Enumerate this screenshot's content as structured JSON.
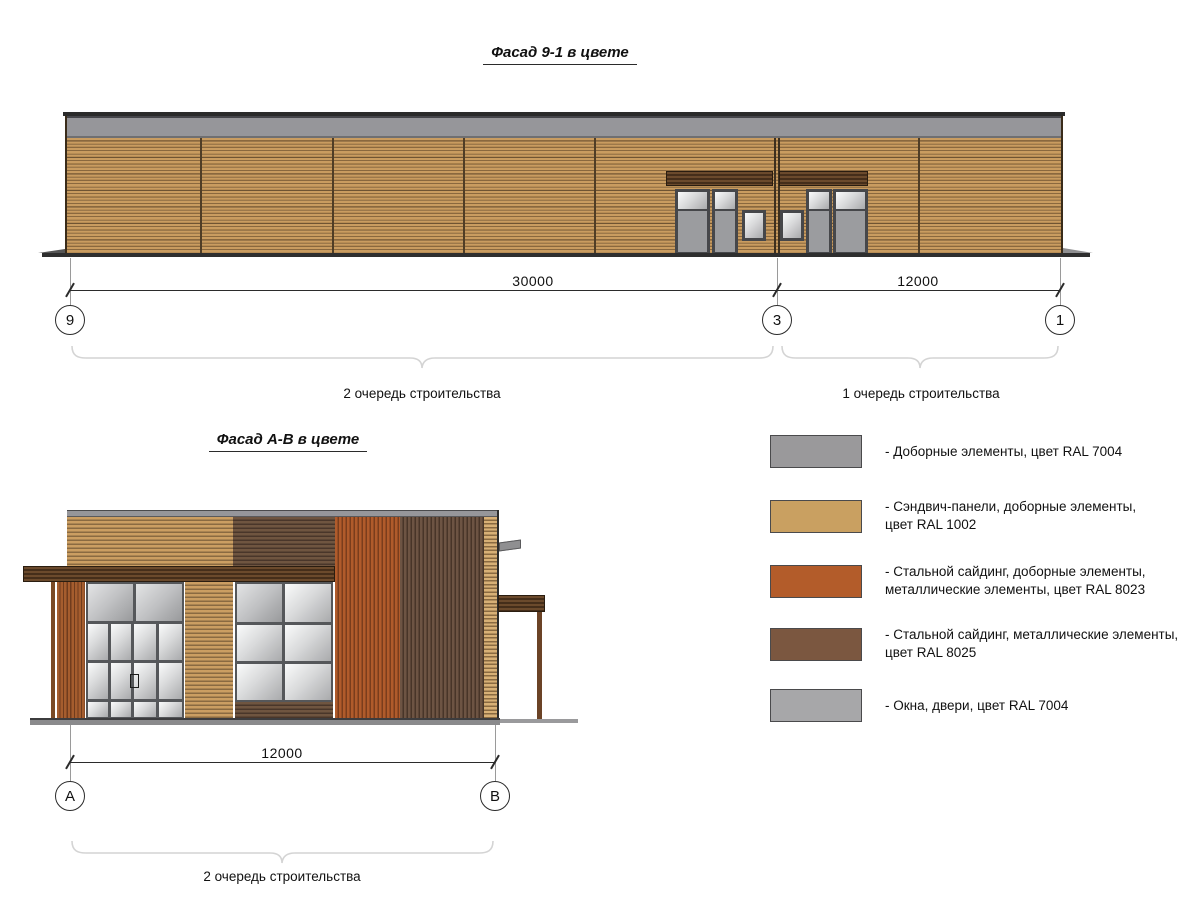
{
  "facade_9_1": {
    "title": "Фасад 9-1 в цвете",
    "dim_9_3": "30000",
    "dim_3_1": "12000",
    "grid_9": "9",
    "grid_3": "3",
    "grid_1": "1",
    "phase_left": "2 очередь строительства",
    "phase_right": "1 очередь строительства"
  },
  "facade_a_b": {
    "title": "Фасад А-В в цвете",
    "dim_a_b": "12000",
    "grid_a": "А",
    "grid_b": "В",
    "phase": "2 очередь строительства"
  },
  "legend": {
    "items": [
      {
        "color": "#9a999b",
        "ral": "RAL 7004",
        "lines": [
          "- Доборные элементы, цвет RAL 7004"
        ]
      },
      {
        "color": "#c9a061",
        "ral": "RAL 1002",
        "lines": [
          "- Сэндвич-панели, доборные элементы,",
          "цвет RAL 1002"
        ]
      },
      {
        "color": "#b35c2a",
        "ral": "RAL 8023",
        "lines": [
          "- Стальной сайдинг, доборные элементы,",
          "металлические элементы, цвет RAL 8023"
        ]
      },
      {
        "color": "#7b5740",
        "ral": "RAL 8025",
        "lines": [
          "- Стальной сайдинг, металлические элементы,",
          "цвет RAL 8025"
        ]
      },
      {
        "color": "#a7a7a9",
        "ral": "RAL 7004",
        "lines": [
          "- Окна, двери, цвет RAL 7004"
        ]
      }
    ]
  }
}
